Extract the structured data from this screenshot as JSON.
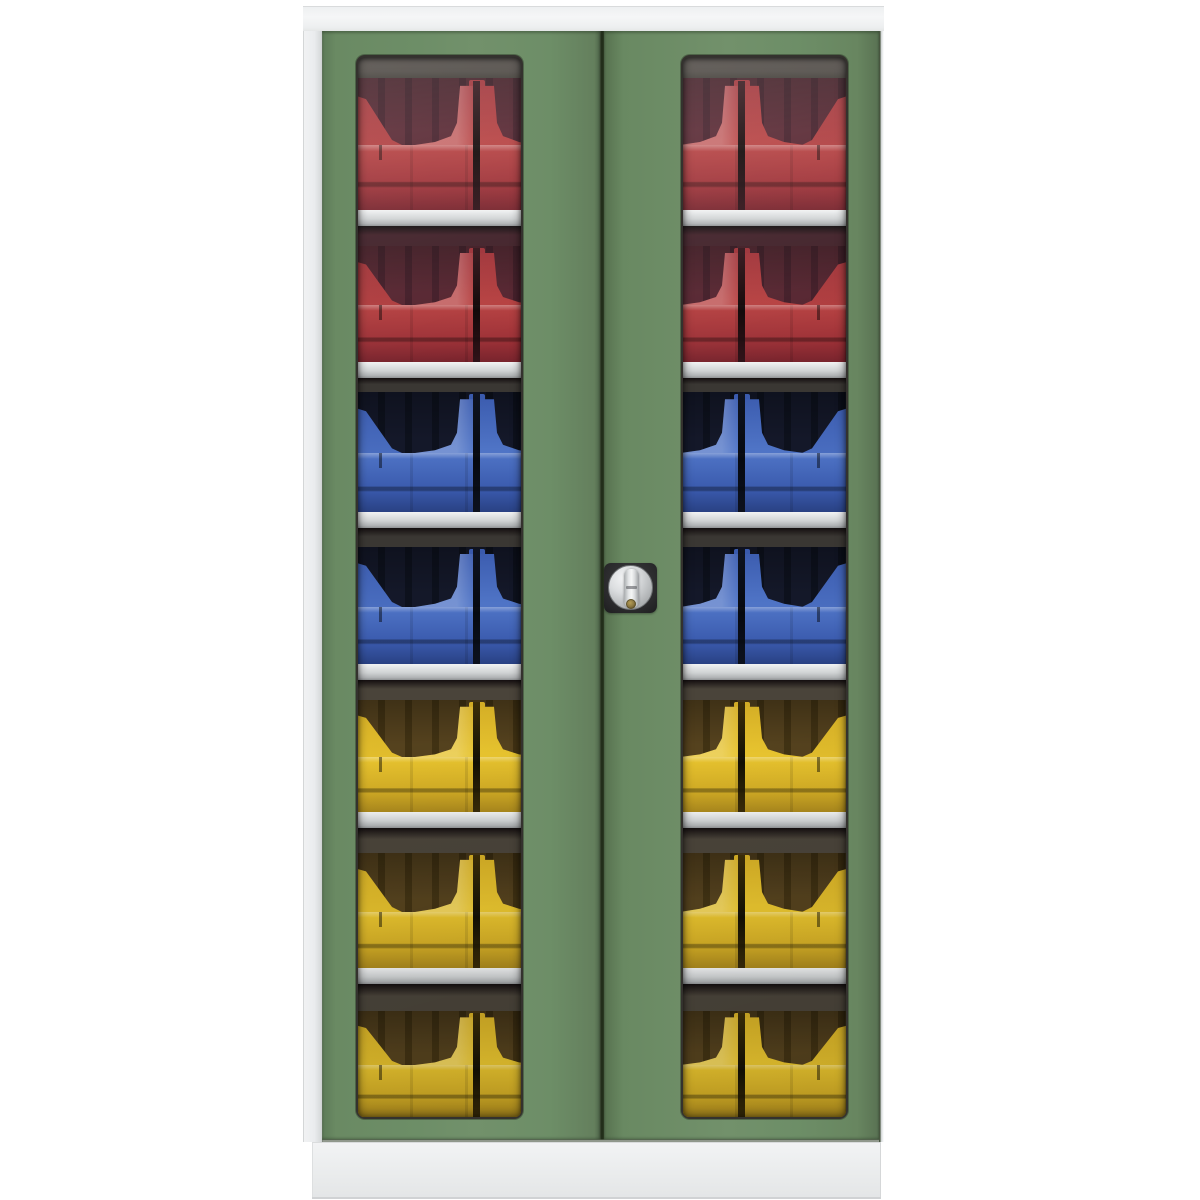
{
  "product_photo": {
    "background_color": "#ffffff",
    "cabinet": {
      "type_name": "double-door-vision-panel-cupboard",
      "frame_color": "#f0f1f2",
      "plinth_color": "#eceef0",
      "door_color": "#6d8e67",
      "door_gap_color": "#202a18",
      "shelf_color": "#d0d3d4",
      "window_count": 2,
      "shelf_count": 6,
      "lock": {
        "plate_color": "#2a2a2c",
        "knob_color": "#c9cbcd",
        "grip_color": "#e6e8e9",
        "keyhole_color": "#8a7640"
      },
      "bin_rows": [
        {
          "position": 1,
          "color_name": "red",
          "bin_color": "#b64040"
        },
        {
          "position": 2,
          "color_name": "red",
          "bin_color": "#b64040"
        },
        {
          "position": 3,
          "color_name": "blue",
          "bin_color": "#4f74c6"
        },
        {
          "position": 4,
          "color_name": "blue",
          "bin_color": "#4f74c6"
        },
        {
          "position": 5,
          "color_name": "yellow",
          "bin_color": "#e9c52f"
        },
        {
          "position": 6,
          "color_name": "yellow",
          "bin_color": "#e9c52f"
        },
        {
          "position": 7,
          "color_name": "yellow",
          "bin_color": "#e9c52f"
        }
      ]
    }
  }
}
